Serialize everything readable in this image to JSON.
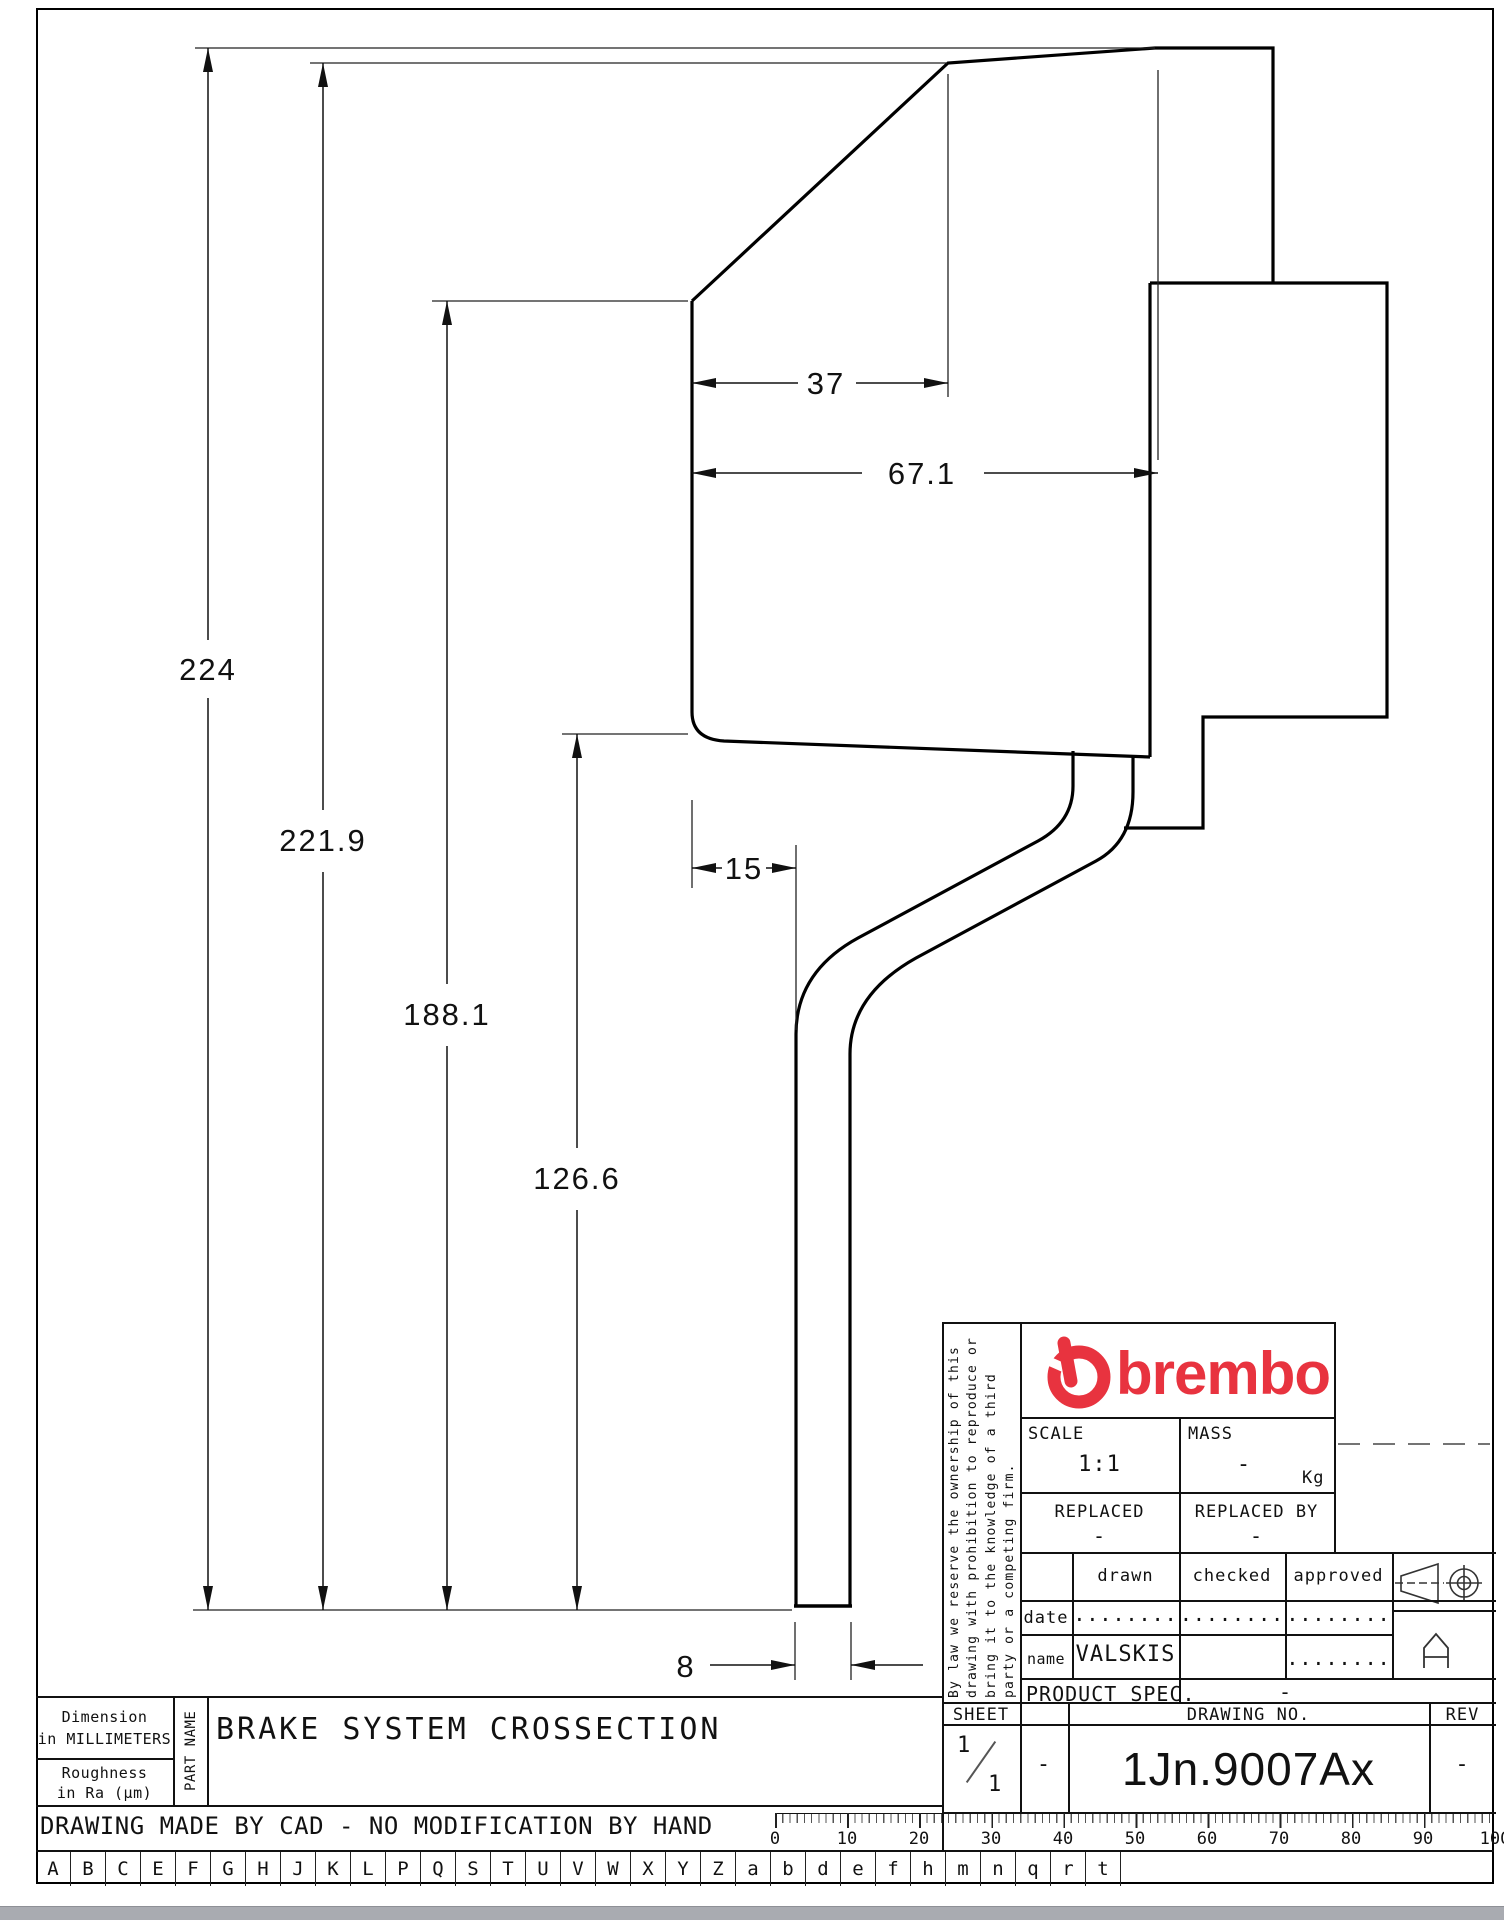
{
  "dimensions": {
    "height_total": "224",
    "height_to_vertex": "221.9",
    "height_to_shoulder": "188.1",
    "height_to_bottom_face": "126.6",
    "width_top": "37",
    "width_face": "67.1",
    "pipe_offset": "15",
    "pipe_width": "8"
  },
  "title_block": {
    "brand": "brembo",
    "scale_label": "SCALE",
    "scale_value": "1:1",
    "mass_label": "MASS",
    "mass_value": "-",
    "mass_unit": "Kg",
    "replaced_label": "REPLACED",
    "replaced_value": "-",
    "replaced_by_label": "REPLACED BY",
    "replaced_by_value": "-",
    "drawn_label": "drawn",
    "checked_label": "checked",
    "approved_label": "approved",
    "date_label": "date",
    "date_drawn": "........",
    "date_checked": "........",
    "date_approved": "........",
    "name_label": "name",
    "name_drawn": "VALSKIS",
    "name_approved": "........",
    "product_spec_label": "PRODUCT SPEC.",
    "product_spec_value": "-"
  },
  "legal_lines": [
    "By law we reserve the ownership of this",
    "drawing with prohibition to reproduce or",
    "bring it to the knowledge of a third",
    "party or a competing firm."
  ],
  "sheet_block": {
    "sheet_label": "SHEET",
    "sheet_num": "1",
    "sheet_den": "1",
    "col2_value": "-",
    "drawing_no_label": "DRAWING NO.",
    "drawing_no": "1Jn.9007Ax",
    "rev_label": "REV",
    "rev_value": "-"
  },
  "footer": {
    "dimension_note_line1": "Dimension",
    "dimension_note_line2": "in MILLIMETERS",
    "roughness_note_line1": "Roughness",
    "roughness_note_line2": "in Ra (µm)",
    "part_name_label": "PART NAME",
    "part_title": "BRAKE SYSTEM CROSSECTION",
    "cad_note": "DRAWING MADE BY CAD - NO MODIFICATION BY HAND"
  },
  "ruler_numbers": [
    "0",
    "10",
    "20",
    "30",
    "40",
    "50",
    "60",
    "70",
    "80",
    "90",
    "100"
  ],
  "letters": [
    "A",
    "B",
    "C",
    "E",
    "F",
    "G",
    "H",
    "J",
    "K",
    "L",
    "P",
    "Q",
    "S",
    "T",
    "U",
    "V",
    "W",
    "X",
    "Y",
    "Z",
    "a",
    "b",
    "d",
    "e",
    "f",
    "h",
    "m",
    "n",
    "q",
    "r",
    "t"
  ],
  "colors": {
    "brand_red": "#e8333f",
    "line": "#111111"
  }
}
